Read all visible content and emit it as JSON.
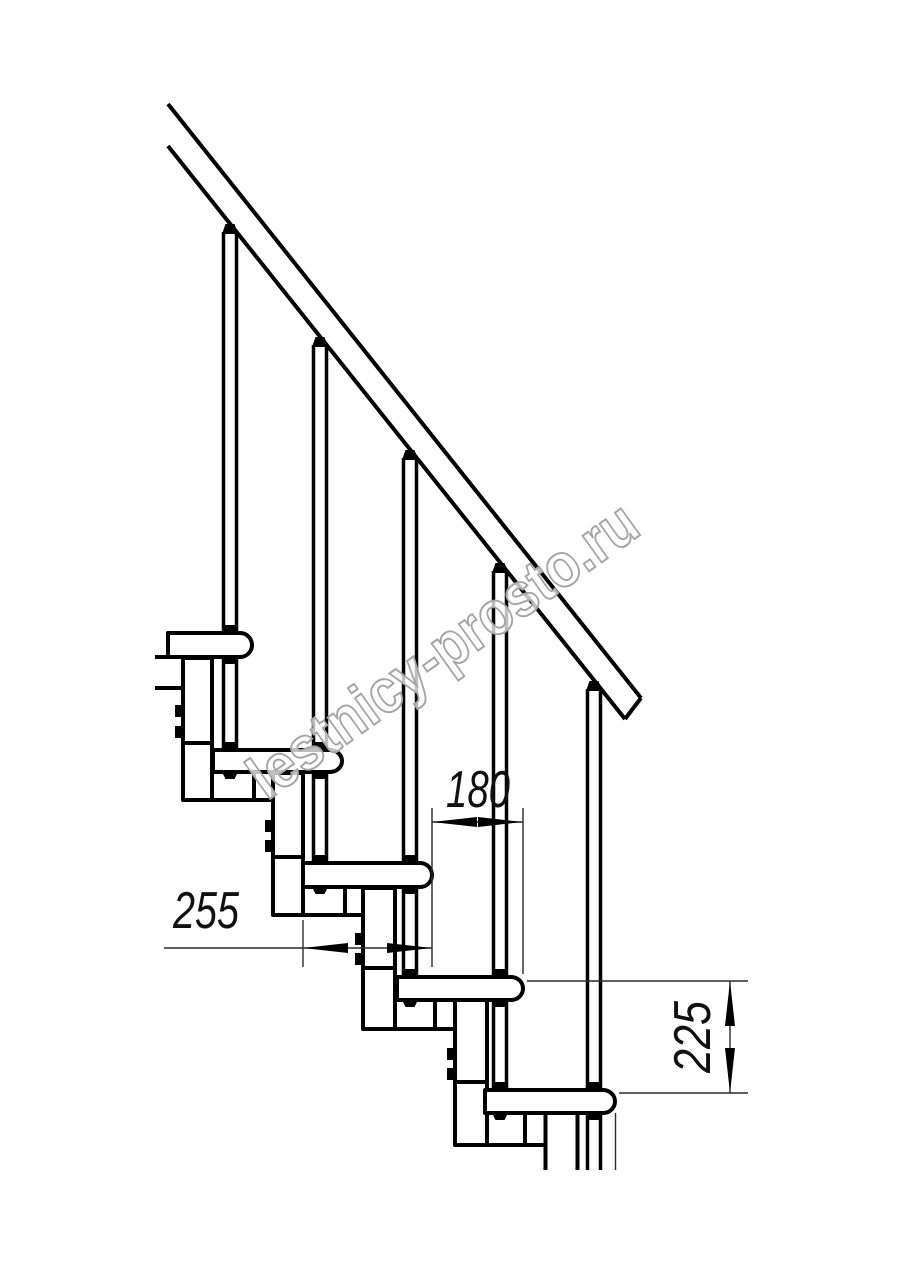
{
  "title": "Modular staircase side elevation drawing",
  "watermark": {
    "text": "lestnicy-prosto.ru",
    "outline_color": "#a5a5a5"
  },
  "dimensions": {
    "step_run": "180",
    "tread_depth": "255",
    "step_rise": "225"
  },
  "colors": {
    "line": "#000000",
    "dimension_line": "#2a2a2a",
    "background": "#ffffff"
  }
}
